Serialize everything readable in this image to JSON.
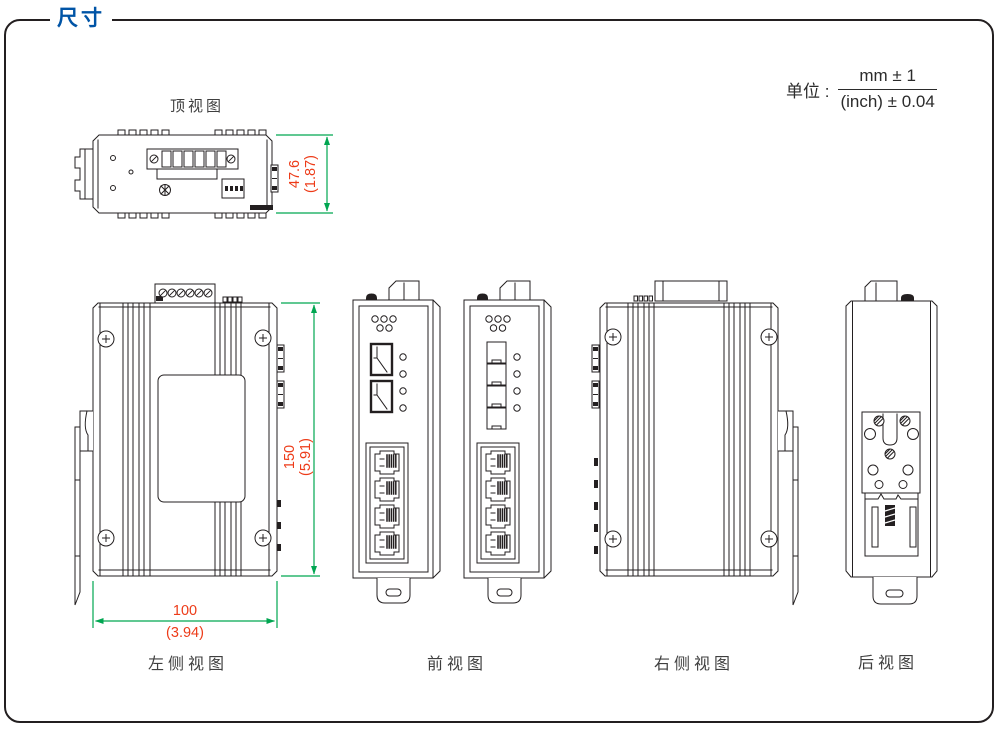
{
  "page": {
    "title": "尺寸"
  },
  "unit_note": {
    "label": "单位 :",
    "numerator": "mm ± 1",
    "denominator": "(inch) ± 0.04"
  },
  "views": {
    "top": "顶视图",
    "left": "左侧视图",
    "front": "前视图",
    "right": "右侧视图",
    "rear": "后视图"
  },
  "dimensions": {
    "depth": {
      "mm": "47.6",
      "inch": "(1.87)"
    },
    "height": {
      "mm": "150",
      "inch": "(5.91)"
    },
    "width": {
      "mm": "100",
      "inch": "(3.94)"
    }
  },
  "colors": {
    "title_blue": "#0054a6",
    "dimension_line_green": "#00a651",
    "dimension_text_red": "#ed3b18",
    "drawing_line": "#231f20"
  }
}
